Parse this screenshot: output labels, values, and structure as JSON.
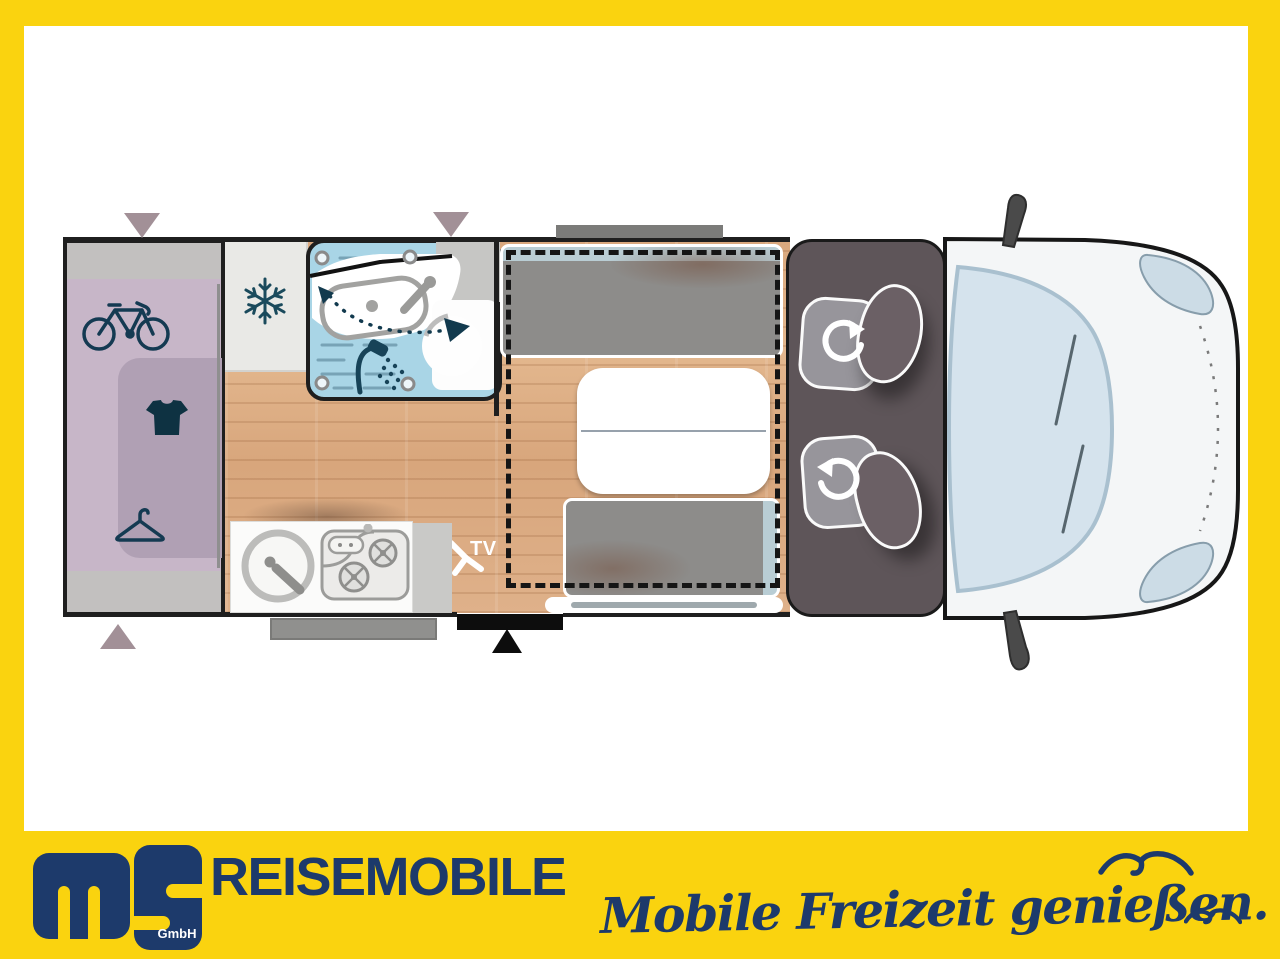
{
  "branding": {
    "monogram": "ms",
    "monogram_suffix": "GmbH",
    "brand": "REISEMOBILE",
    "slogan": "Mobile Freizeit genießen.",
    "accent_yellow": "#FAD30F",
    "navy": "#1D3A6B"
  },
  "floorplan": {
    "tv_label": "TV",
    "areas": [
      "rear-garage",
      "wardrobe",
      "fridge",
      "bathroom",
      "kitchen",
      "dinette",
      "drop-down-bed",
      "cab-swivel-seats",
      "vehicle-front"
    ],
    "icons": [
      "bicycle-icon",
      "tshirt-icon",
      "hanger-icon",
      "snowflake-icon",
      "shower-icon",
      "washbasin",
      "toilet",
      "sink",
      "stove",
      "tv-mount-icon",
      "rotate-arrow-icon",
      "door-marker",
      "window-marker",
      "seagull-icon"
    ],
    "colors": {
      "wood_floor": "#DCAB83",
      "bathroom_blue": "#A9D5E6",
      "garage_lavender": "#C7B6C8",
      "wardrobe_purple": "#B0A0B4",
      "bench_gray": "#8D8C8A",
      "headrest_blue": "#B9CDD4",
      "cab_dark": "#5E5559",
      "vehicle_body": "#F4F6F7",
      "windshield": "#D5E3ED",
      "wall": "#1F1F1F"
    }
  }
}
